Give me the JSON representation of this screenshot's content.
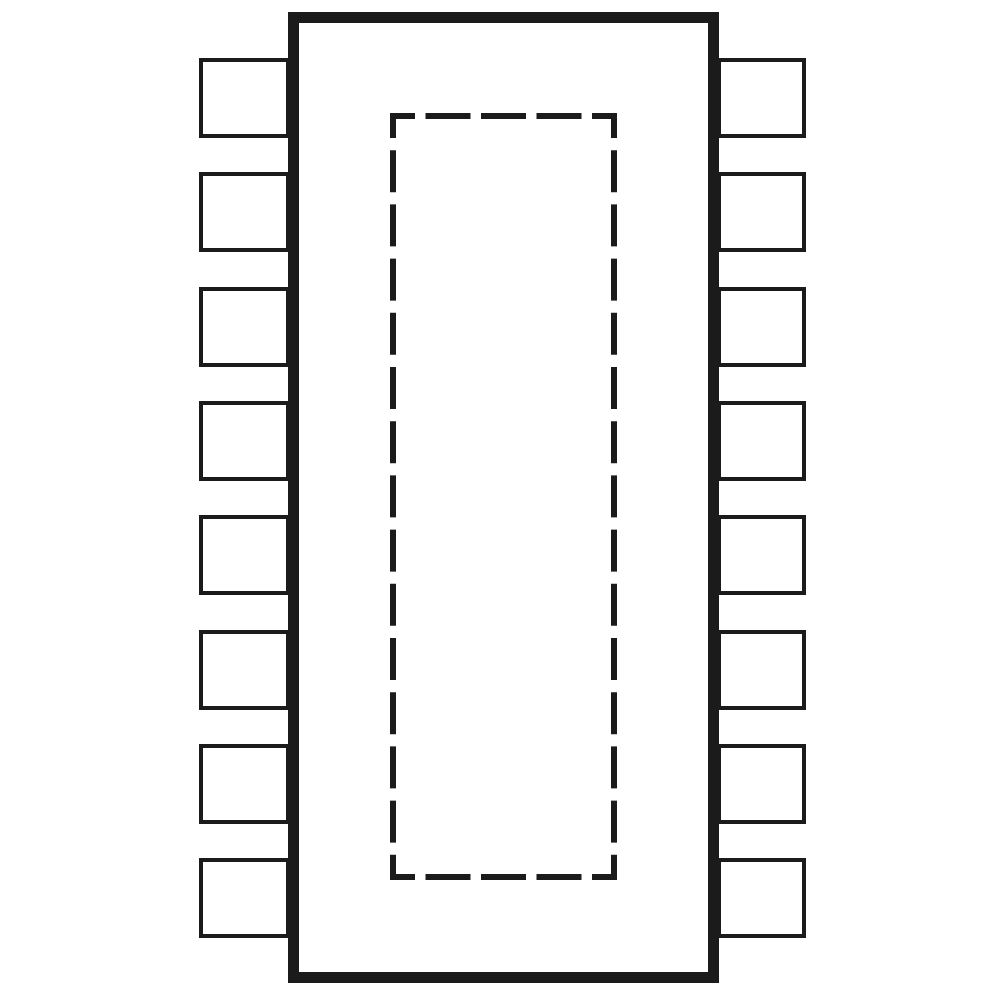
{
  "diagram": {
    "kind": "ic-package-outline-top-view",
    "canvas": {
      "width": 1000,
      "height": 1000,
      "background": "#ffffff"
    },
    "colors": {
      "line": "#1b1b1b",
      "body_fill": "#ffffff",
      "pin_fill": "#ffffff"
    },
    "body": {
      "x": 288,
      "y": 12,
      "width": 431,
      "height": 971,
      "stroke_width": 11
    },
    "exposed_pad": {
      "x": 390,
      "y": 113,
      "width": 227,
      "height": 767,
      "stroke_width": 6,
      "horizontal_dash": {
        "corner": 25,
        "dash": 45,
        "gap": 10.5,
        "middle_dashes": 3
      },
      "vertical_dash": {
        "corner": 25,
        "dash": 42,
        "gap": 12.2,
        "middle_dashes": 13
      }
    },
    "pins": {
      "count_per_side": 8,
      "total": 16,
      "stroke_width": 4,
      "height": 80,
      "left": {
        "x": 199,
        "width": 91
      },
      "right": {
        "x": 717,
        "width": 89
      },
      "tops": [
        58,
        172,
        287,
        401,
        515,
        630,
        744,
        858
      ]
    }
  }
}
